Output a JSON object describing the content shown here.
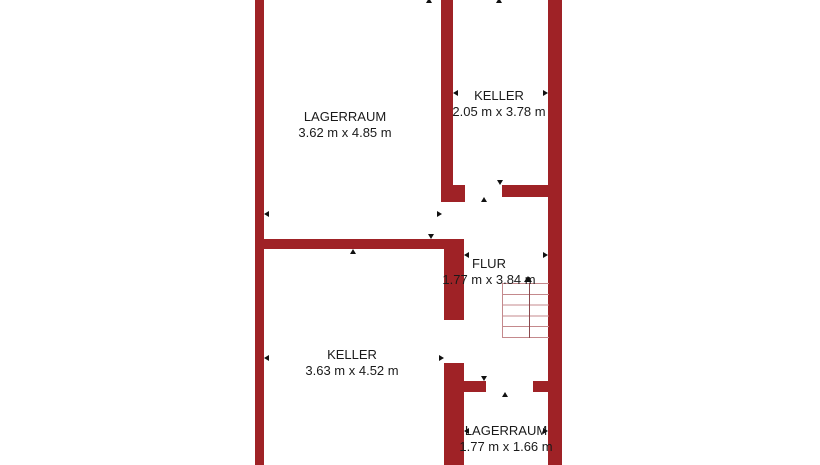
{
  "plan": {
    "title": "basement floor plan",
    "rooms": [
      {
        "id": "lagerraum-top",
        "name": "LAGERRAUM",
        "dims": "3.62 m x 4.85 m"
      },
      {
        "id": "keller-top",
        "name": "KELLER",
        "dims": "2.05 m x 3.78 m"
      },
      {
        "id": "flur",
        "name": "FLUR",
        "dims": "1.77 m x 3.84 m"
      },
      {
        "id": "keller-bottom",
        "name": "KELLER",
        "dims": "3.63 m x 4.52 m"
      },
      {
        "id": "lagerraum-bottom",
        "name": "LAGERRAUM",
        "dims": "1.77 m x 1.66 m"
      }
    ],
    "stairs": {
      "treads": 6,
      "direction": "up"
    },
    "colors": {
      "wall": "#9f2226",
      "stair_tread": "#c4898c",
      "stair_walkline": "#8a4a4e",
      "text": "#1a1a1a",
      "arrow": "#111111",
      "background": "#ffffff"
    }
  }
}
